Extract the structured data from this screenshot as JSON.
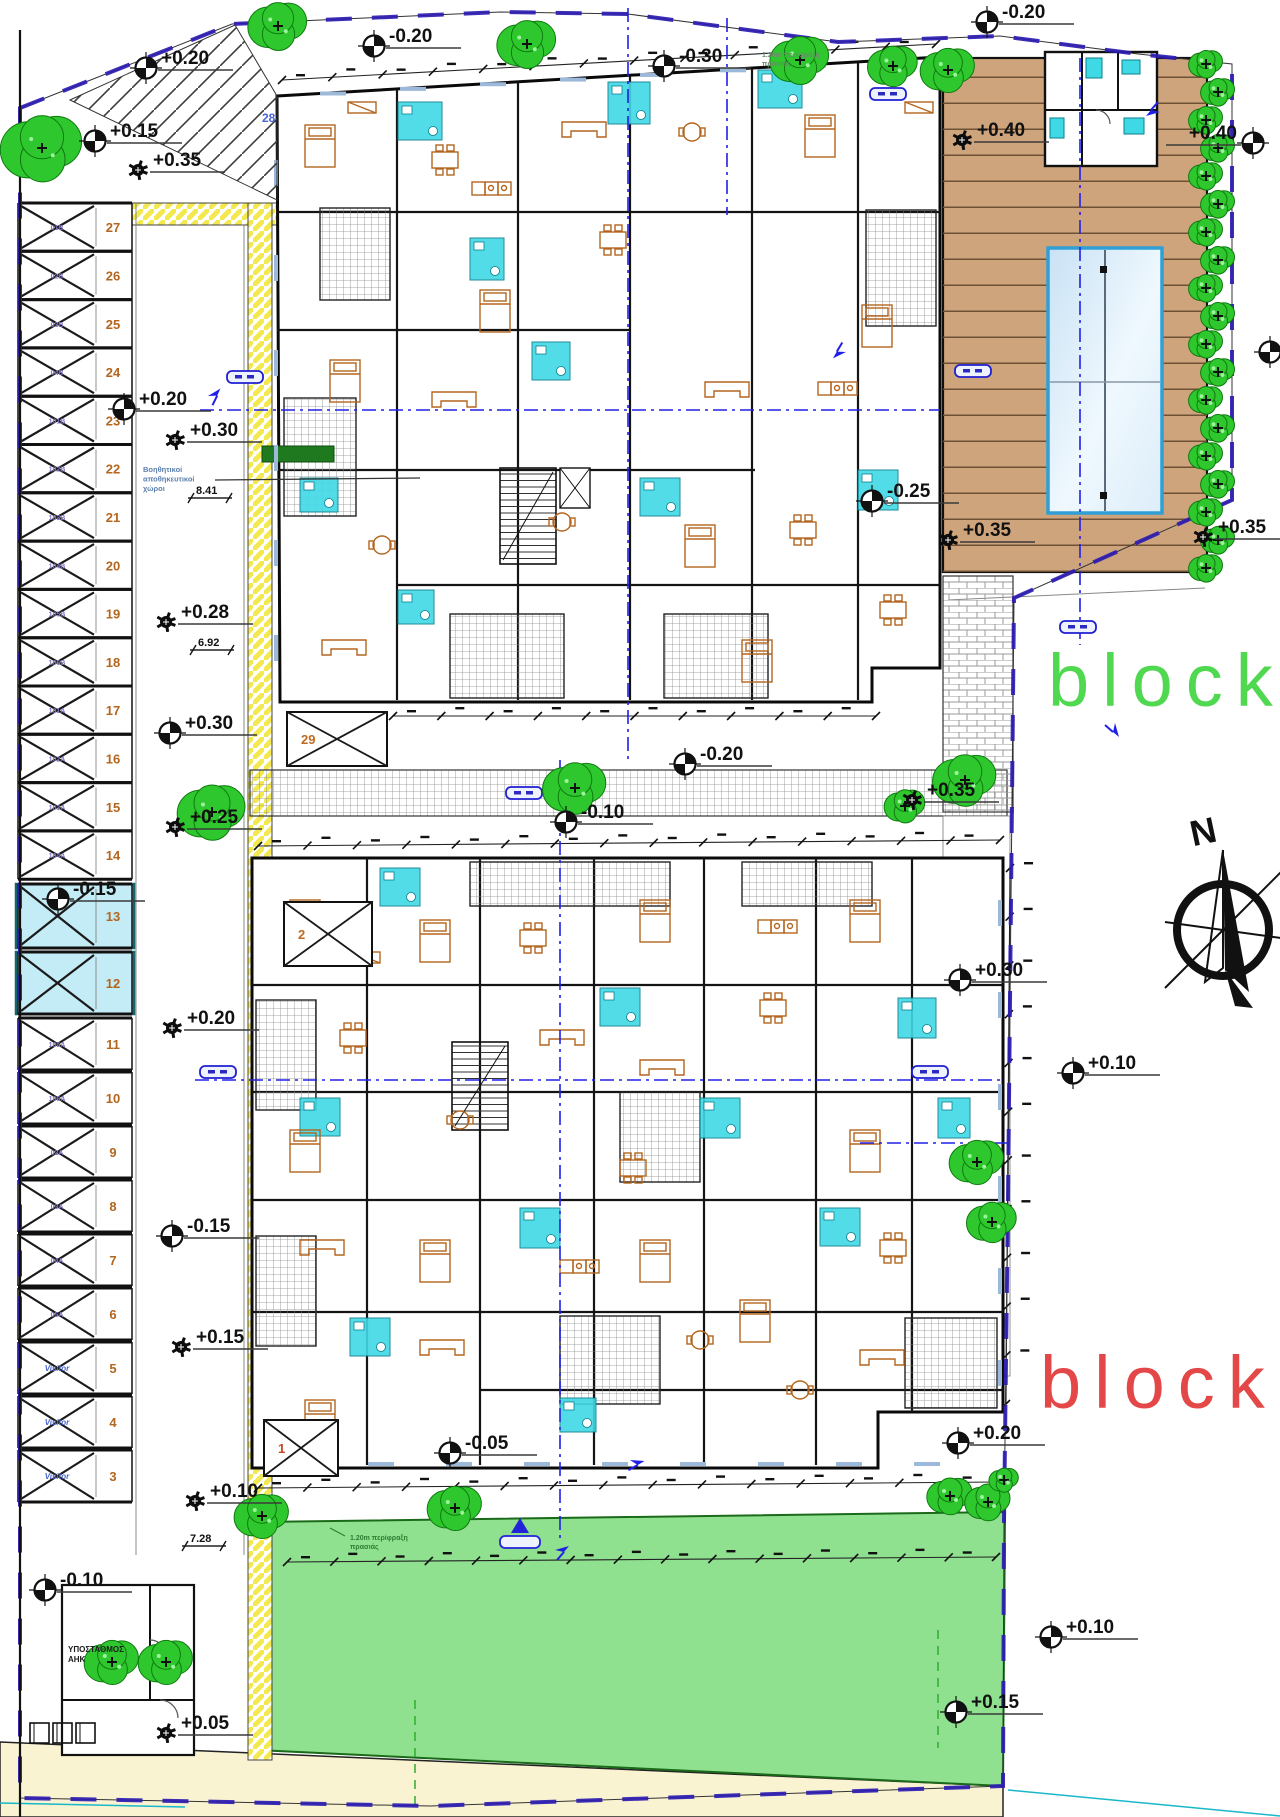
{
  "site": {
    "block_labels": [
      {
        "text": "block",
        "color": "#3fd43f",
        "x": 1048,
        "y": 706
      },
      {
        "text": "block",
        "color": "#e23434",
        "x": 1040,
        "y": 1408
      }
    ],
    "compass": {
      "label": "N"
    },
    "elevation_markers": [
      {
        "value": "+0.20",
        "x": 146,
        "y": 68,
        "style": "circle"
      },
      {
        "value": "+0.15",
        "x": 95,
        "y": 141,
        "style": "circle"
      },
      {
        "value": "+0.35",
        "x": 138,
        "y": 170,
        "style": "spot"
      },
      {
        "value": "-0.20",
        "x": 374,
        "y": 46,
        "style": "circle"
      },
      {
        "value": "-0.30",
        "x": 664,
        "y": 66,
        "style": "circle"
      },
      {
        "value": "-0.20",
        "x": 987,
        "y": 22,
        "style": "circle"
      },
      {
        "value": "+0.40",
        "x": 962,
        "y": 140,
        "style": "spot"
      },
      {
        "value": "+0.40",
        "x": 1253,
        "y": 143,
        "style": "circle",
        "side": "left"
      },
      {
        "value": "",
        "x": 1270,
        "y": 352,
        "style": "circle"
      },
      {
        "value": "-0.25",
        "x": 872,
        "y": 501,
        "style": "circle"
      },
      {
        "value": "+0.35",
        "x": 948,
        "y": 540,
        "style": "spot"
      },
      {
        "value": "+0.35",
        "x": 1203,
        "y": 537,
        "style": "spot"
      },
      {
        "value": "+0.20",
        "x": 124,
        "y": 409,
        "style": "circle"
      },
      {
        "value": "+0.30",
        "x": 175,
        "y": 440,
        "style": "spot"
      },
      {
        "value": "+0.28",
        "x": 166,
        "y": 622,
        "style": "spot"
      },
      {
        "value": "+0.30",
        "x": 170,
        "y": 733,
        "style": "circle"
      },
      {
        "value": "+0.25",
        "x": 175,
        "y": 827,
        "style": "spot"
      },
      {
        "value": "-0.15",
        "x": 58,
        "y": 899,
        "style": "circle"
      },
      {
        "value": "+0.20",
        "x": 172,
        "y": 1028,
        "style": "spot"
      },
      {
        "value": "-0.15",
        "x": 172,
        "y": 1236,
        "style": "circle"
      },
      {
        "value": "+0.15",
        "x": 181,
        "y": 1347,
        "style": "spot"
      },
      {
        "value": "+0.10",
        "x": 195,
        "y": 1501,
        "style": "spot"
      },
      {
        "value": "-0.10",
        "x": 45,
        "y": 1590,
        "style": "circle"
      },
      {
        "value": "+0.05",
        "x": 166,
        "y": 1733,
        "style": "spot"
      },
      {
        "value": "-0.05",
        "x": 450,
        "y": 1453,
        "style": "circle"
      },
      {
        "value": "-0.20",
        "x": 685,
        "y": 764,
        "style": "circle"
      },
      {
        "value": "-0.10",
        "x": 566,
        "y": 822,
        "style": "circle"
      },
      {
        "value": "+0.35",
        "x": 912,
        "y": 800,
        "style": "spot"
      },
      {
        "value": "+0.30",
        "x": 960,
        "y": 980,
        "style": "circle"
      },
      {
        "value": "+0.10",
        "x": 1073,
        "y": 1073,
        "style": "circle"
      },
      {
        "value": "+0.20",
        "x": 958,
        "y": 1443,
        "style": "circle"
      },
      {
        "value": "+0.10",
        "x": 1051,
        "y": 1637,
        "style": "circle"
      },
      {
        "value": "+0.15",
        "x": 956,
        "y": 1712,
        "style": "circle"
      }
    ],
    "dimensions": [
      {
        "text": "8.41",
        "x": 196,
        "y": 494
      },
      {
        "text": "6.92",
        "x": 198,
        "y": 646
      },
      {
        "text": "7.28",
        "x": 190,
        "y": 1542
      }
    ],
    "notes": [
      {
        "lines": [
          "Βοηθητικοί",
          "αποθηκευτικοί",
          "χώροι"
        ],
        "x": 143,
        "y": 472,
        "color": "#5b7fae",
        "size": 7.5
      },
      {
        "lines": [
          "1.20m περίφραξη",
          "πρασιάς"
        ],
        "x": 762,
        "y": 57,
        "color": "#6b8a6b",
        "size": 7
      },
      {
        "lines": [
          "1.20m περίφραξη",
          "πρασιάς"
        ],
        "x": 350,
        "y": 1540,
        "color": "#2e7d32",
        "size": 7
      },
      {
        "lines": [
          "ΥΠΟΣΤΑΘΜΟΣ",
          "ΑΗΚ"
        ],
        "x": 68,
        "y": 1652,
        "color": "#1a1a1a",
        "size": 8
      }
    ],
    "parking": {
      "angled_stall_number": "28",
      "stalls": [
        {
          "number": "27",
          "code": "01B"
        },
        {
          "number": "26",
          "code": "02B"
        },
        {
          "number": "25",
          "code": "03B"
        },
        {
          "number": "24",
          "code": "04B"
        },
        {
          "number": "23",
          "code": "101B"
        },
        {
          "number": "22",
          "code": "102B"
        },
        {
          "number": "21",
          "code": "103B"
        },
        {
          "number": "20",
          "code": "104B"
        },
        {
          "number": "19",
          "code": "105B"
        },
        {
          "number": "18",
          "code": "106B"
        },
        {
          "number": "17",
          "code": "101A"
        },
        {
          "number": "16",
          "code": "102A"
        },
        {
          "number": "15",
          "code": "103A"
        },
        {
          "number": "14",
          "code": "104A"
        },
        {
          "number": "13",
          "code": "",
          "highlighted": true
        },
        {
          "number": "12",
          "code": "",
          "highlighted": true
        },
        {
          "number": "11",
          "code": "105A"
        },
        {
          "number": "10",
          "code": "106A"
        },
        {
          "number": "9",
          "code": "02A"
        },
        {
          "number": "8",
          "code": "03A"
        },
        {
          "number": "7",
          "code": "04A"
        },
        {
          "number": "6",
          "code": "05A"
        },
        {
          "number": "5",
          "code": "Visitor"
        },
        {
          "number": "4",
          "code": "Visitor"
        },
        {
          "number": "3",
          "code": "Visitor"
        }
      ],
      "ramp_boxes": [
        {
          "number": "29",
          "x": 287,
          "y": 712,
          "w": 100,
          "h": 54,
          "color": "#c06a20"
        },
        {
          "number": "2",
          "x": 284,
          "y": 902,
          "w": 88,
          "h": 64,
          "color": "#c06a20"
        },
        {
          "number": "1",
          "x": 264,
          "y": 1420,
          "w": 74,
          "h": 56,
          "color": "#cc4422"
        }
      ]
    }
  }
}
